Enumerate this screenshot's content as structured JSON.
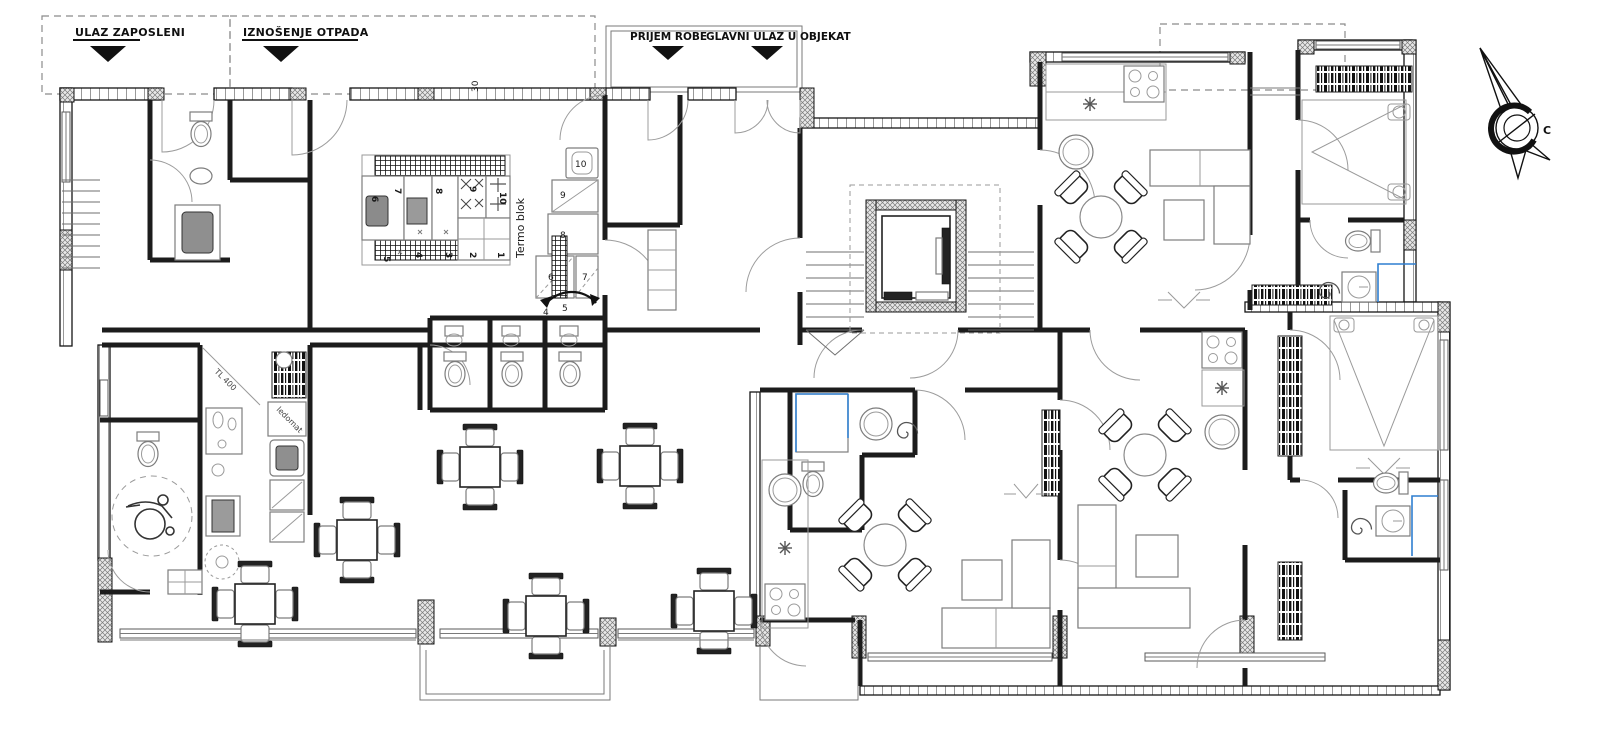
{
  "drawing": {
    "kind": "architectural ground-floor plan",
    "annotations": {
      "entrances": [
        {
          "label": "ULAZ ZAPOSLENI"
        },
        {
          "label": "IZNOŠENJE OTPADA"
        },
        {
          "label": "PRIJEM ROBE"
        },
        {
          "label": "GLAVNI ULAZ U OBJEKAT"
        }
      ],
      "kitchen_block_label": "Termo blok",
      "dimension_30": "30",
      "bar_label_tl400": "TL 400",
      "bar_label_ledomat": "ledomat",
      "kitchen_numbers_top": [
        "6",
        "7",
        "8",
        "9",
        "10"
      ],
      "kitchen_numbers_bottom": [
        "5",
        "4",
        "3",
        "2",
        "1"
      ],
      "serving_numbers": [
        "10",
        "9",
        "8",
        "6",
        "7",
        "4",
        "5"
      ],
      "compass_letter": "C"
    },
    "colors": {
      "wall": "#151515",
      "furniture": "#7d7d7d",
      "plumbing_highlight": "#2f7fd0",
      "canopy_dash": "#8b8b8b"
    }
  }
}
